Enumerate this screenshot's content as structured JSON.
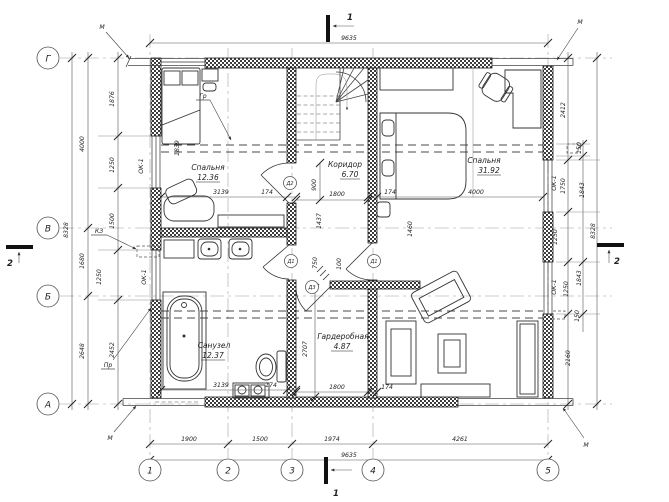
{
  "axes": {
    "rows": [
      "Г",
      "В",
      "Б",
      "А"
    ],
    "cols": [
      "1",
      "2",
      "3",
      "4",
      "5"
    ]
  },
  "sections": {
    "s1": "1",
    "s2": "2"
  },
  "rooms": {
    "bedroom1": {
      "name": "Спальня",
      "area": "12.36"
    },
    "bathroom": {
      "name": "Санузел",
      "area": "12.37"
    },
    "corridor": {
      "name": "Коридор",
      "area": "6.70"
    },
    "bedroom2": {
      "name": "Спальня",
      "area": "31.92"
    },
    "wardrobe": {
      "name": "Гардеробная",
      "area": "4.87"
    }
  },
  "marks": {
    "window": "ОК-1",
    "door1": "Д1",
    "door2": "Д2",
    "door3": "Д3",
    "metal": "М",
    "gr": "Гр",
    "pr": "Пр",
    "kz": "КЗ"
  },
  "dims": {
    "top_total": "9635",
    "bottom": [
      "1900",
      "1500",
      "1974",
      "4261"
    ],
    "bottom_total": "9635",
    "left_total": "8328",
    "left_axis": [
      "4000",
      "1680",
      "2648"
    ],
    "left_detail": [
      "1876",
      "1250",
      "1500",
      "1250",
      "2452"
    ],
    "right_total": "8328",
    "right_upper": [
      "2412",
      "150",
      "1750",
      "1843",
      "1250"
    ],
    "right_lower": [
      "1843",
      "1250",
      "150",
      "2160"
    ],
    "bedroom1": [
      "3139",
      "174",
      "1839"
    ],
    "bathroom": [
      "3139",
      "174"
    ],
    "bedroom2": [
      "174",
      "4000",
      "1460"
    ],
    "corridor": [
      "900",
      "1800",
      "1437",
      "750",
      "100"
    ],
    "wardrobe": [
      "2707",
      "1800",
      "174"
    ]
  }
}
